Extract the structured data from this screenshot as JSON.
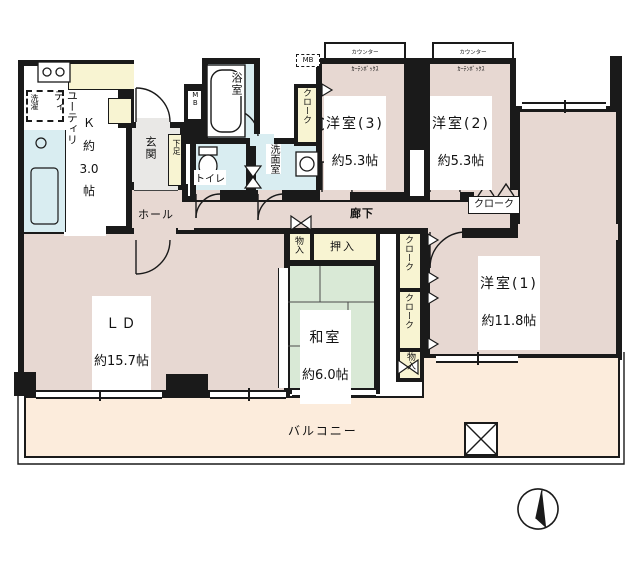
{
  "colors": {
    "wall": "#1a1a1a",
    "western_room": "#e7d8d2",
    "tatami_room": "#d9e9d6",
    "water_room": "#d9edf1",
    "closet": "#f8f4d2",
    "balcony": "#fcecdc",
    "genkan": "#e9e8e6",
    "white": "#ffffff"
  },
  "rooms": {
    "ld": {
      "name": "ＬＤ",
      "size": "約15.7帖"
    },
    "washitsu": {
      "name": "和室",
      "size": "約6.0帖"
    },
    "yoshitsu1": {
      "name": "洋室(1)",
      "size": "約11.8帖"
    },
    "yoshitsu2": {
      "name": "洋室(2)",
      "size": "約5.3帖"
    },
    "yoshitsu3": {
      "name": "洋室(3)",
      "size": "約5.3帖"
    },
    "kitchen": {
      "utility": "ユーティリティ",
      "label": "Ｋ\n約\n3.0\n帖"
    },
    "genkan": "玄関",
    "hall": "ホール",
    "corridor": "廊下",
    "toilet": "トイレ",
    "bath": "浴室",
    "washroom": "洗面室",
    "balcony": "バルコニー"
  },
  "storage": {
    "oshiire": "押入",
    "cloak": "クローク",
    "monoire": "物入",
    "shoe": "下足",
    "meter_box": "MB",
    "laundry": "洗濯"
  },
  "window_notes": {
    "bay_counter": "カウンター",
    "curtain_box": "ｶｰﾃﾝﾎﾞｯｸｽ"
  }
}
